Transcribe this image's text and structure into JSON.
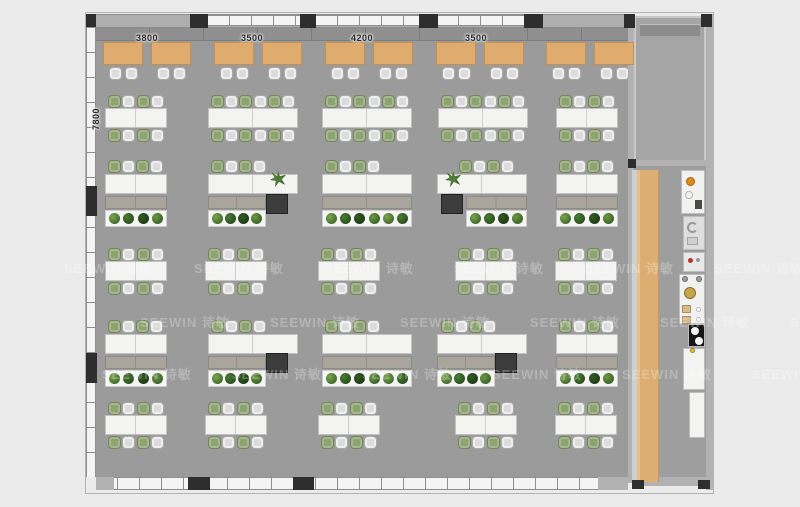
{
  "watermark": {
    "text": "SEEWIN 诗敏"
  },
  "dimensions": {
    "top": [
      "3800",
      "3500",
      "4200",
      "3500"
    ],
    "left": "7800"
  },
  "palette": {
    "floor": "#9b9b9b",
    "corridor_floor": "#9e9e9e",
    "room_floor": "#a5a5a5",
    "wood": "#dcae72",
    "desk": "#f3f3f1",
    "chair_green": "#8da371",
    "chair_grey": "#dcdcdc",
    "credenza": "#a9a59d",
    "column": "#2e2e2e",
    "accent_orange": "#e08a1e"
  },
  "floorplan": {
    "booth": {
      "tables_x": [
        103,
        151,
        214,
        262,
        325,
        373,
        436,
        484,
        546,
        594
      ],
      "table_y": 42,
      "table_w": 40,
      "table_h": 23,
      "chair_y": 67
    },
    "bench_clusters": [
      {
        "x": 105,
        "w": 62,
        "y": 95,
        "seats": 4
      },
      {
        "x": 208,
        "w": 90,
        "y": 95,
        "seats": 6
      },
      {
        "x": 322,
        "w": 90,
        "y": 95,
        "seats": 6
      },
      {
        "x": 438,
        "w": 90,
        "y": 95,
        "seats": 6
      },
      {
        "x": 556,
        "w": 62,
        "y": 95,
        "seats": 4
      },
      {
        "x": 105,
        "w": 62,
        "y": 248,
        "seats": 4
      },
      {
        "x": 205,
        "w": 62,
        "y": 248,
        "seats": 4
      },
      {
        "x": 318,
        "w": 62,
        "y": 248,
        "seats": 4
      },
      {
        "x": 455,
        "w": 62,
        "y": 248,
        "seats": 4
      },
      {
        "x": 555,
        "w": 62,
        "y": 248,
        "seats": 4
      },
      {
        "x": 105,
        "w": 62,
        "y": 402,
        "seats": 4
      },
      {
        "x": 205,
        "w": 62,
        "y": 402,
        "seats": 4
      },
      {
        "x": 318,
        "w": 62,
        "y": 402,
        "seats": 4
      },
      {
        "x": 455,
        "w": 62,
        "y": 402,
        "seats": 4
      },
      {
        "x": 555,
        "w": 62,
        "y": 402,
        "seats": 4
      }
    ],
    "manager_groups": [
      {
        "y": 160,
        "desk": {
          "x": 105,
          "w": 62
        },
        "chairs_x": 108,
        "credenza": {
          "x": 105,
          "w": 62
        },
        "planter": {
          "x": 105,
          "w": 62,
          "plants": 4
        }
      },
      {
        "y": 160,
        "desk": {
          "x": 208,
          "w": 90
        },
        "chairs_x": 211,
        "credenza": {
          "x": 208,
          "w": 58
        },
        "planter": {
          "x": 208,
          "w": 58,
          "plants": 4
        },
        "side_table": {
          "x": 266,
          "y": 194
        },
        "pot": {
          "x": 270,
          "y": 171
        }
      },
      {
        "y": 160,
        "desk": {
          "x": 322,
          "w": 90
        },
        "chairs_x": 325,
        "credenza": {
          "x": 322,
          "w": 90
        },
        "planter": {
          "x": 322,
          "w": 90,
          "plants": 6
        }
      },
      {
        "y": 160,
        "desk": {
          "x": 437,
          "w": 90
        },
        "chairs_x": 459,
        "credenza": {
          "x": 466,
          "w": 61
        },
        "planter": {
          "x": 466,
          "w": 61,
          "plants": 4
        },
        "side_table": {
          "x": 441,
          "y": 194
        },
        "pot": {
          "x": 445,
          "y": 171
        }
      },
      {
        "y": 160,
        "desk": {
          "x": 556,
          "w": 62
        },
        "chairs_x": 559,
        "credenza": {
          "x": 556,
          "w": 62
        },
        "planter": {
          "x": 556,
          "w": 62,
          "plants": 4
        }
      },
      {
        "y": 320,
        "desk": {
          "x": 105,
          "w": 62
        },
        "chairs_x": 108,
        "credenza": {
          "x": 105,
          "w": 62
        },
        "planter": {
          "x": 105,
          "w": 62,
          "plants": 4
        }
      },
      {
        "y": 320,
        "desk": {
          "x": 208,
          "w": 90
        },
        "chairs_x": 211,
        "credenza": {
          "x": 208,
          "w": 58
        },
        "planter": {
          "x": 208,
          "w": 58,
          "plants": 4
        },
        "side_table": {
          "x": 266,
          "y": 353
        }
      },
      {
        "y": 320,
        "desk": {
          "x": 322,
          "w": 90
        },
        "chairs_x": 325,
        "credenza": {
          "x": 322,
          "w": 90
        },
        "planter": {
          "x": 322,
          "w": 90,
          "plants": 6
        }
      },
      {
        "y": 320,
        "desk": {
          "x": 437,
          "w": 90
        },
        "chairs_x": 441,
        "credenza": {
          "x": 437,
          "w": 58
        },
        "planter": {
          "x": 437,
          "w": 58,
          "plants": 4
        },
        "side_table": {
          "x": 495,
          "y": 353
        }
      },
      {
        "y": 320,
        "desk": {
          "x": 556,
          "w": 62
        },
        "chairs_x": 559,
        "credenza": {
          "x": 556,
          "w": 62
        },
        "planter": {
          "x": 556,
          "w": 62,
          "plants": 4
        }
      }
    ],
    "columns": [
      {
        "x": 86,
        "y": 14,
        "w": 10,
        "h": 13
      },
      {
        "x": 190,
        "y": 14,
        "w": 18,
        "h": 14
      },
      {
        "x": 300,
        "y": 14,
        "w": 16,
        "h": 14
      },
      {
        "x": 419,
        "y": 14,
        "w": 19,
        "h": 14
      },
      {
        "x": 524,
        "y": 14,
        "w": 19,
        "h": 14
      },
      {
        "x": 624,
        "y": 14,
        "w": 11,
        "h": 14
      },
      {
        "x": 701,
        "y": 14,
        "w": 11,
        "h": 13
      },
      {
        "x": 86,
        "y": 186,
        "w": 11,
        "h": 30
      },
      {
        "x": 86,
        "y": 353,
        "w": 11,
        "h": 30
      },
      {
        "x": 628,
        "y": 159,
        "w": 8,
        "h": 9
      },
      {
        "x": 188,
        "y": 477,
        "w": 22,
        "h": 13
      },
      {
        "x": 293,
        "y": 477,
        "w": 21,
        "h": 13
      },
      {
        "x": 632,
        "y": 480,
        "w": 12,
        "h": 9
      },
      {
        "x": 698,
        "y": 480,
        "w": 12,
        "h": 9
      }
    ],
    "top_windows": [
      [
        208,
        92
      ],
      [
        316,
        103
      ],
      [
        437,
        87
      ]
    ],
    "pantry_units": [
      {
        "name": "pantry-sink-unit",
        "x": 681,
        "y": 170,
        "w": 24,
        "h": 44,
        "fill": "#f1f1f0",
        "deco": "sink"
      },
      {
        "name": "water-dispenser",
        "x": 683,
        "y": 216,
        "w": 22,
        "h": 34,
        "fill": "#dedede",
        "deco": "cfix"
      },
      {
        "name": "small-appliance",
        "x": 683,
        "y": 252,
        "w": 22,
        "h": 20,
        "fill": "#e9e9e9",
        "deco": "red"
      },
      {
        "name": "prep-counter",
        "x": 679,
        "y": 274,
        "w": 26,
        "h": 50,
        "fill": "#f1f1f0",
        "deco": "prep"
      },
      {
        "name": "cooktop",
        "x": 688,
        "y": 324,
        "w": 17,
        "h": 23,
        "fill": "#161616",
        "deco": "burners"
      },
      {
        "name": "cabinet",
        "x": 683,
        "y": 348,
        "w": 22,
        "h": 42,
        "fill": "#f3f3f2",
        "deco": "none"
      },
      {
        "name": "cabinet",
        "x": 689,
        "y": 392,
        "w": 16,
        "h": 46,
        "fill": "#f3f3f2",
        "deco": "none"
      }
    ]
  }
}
